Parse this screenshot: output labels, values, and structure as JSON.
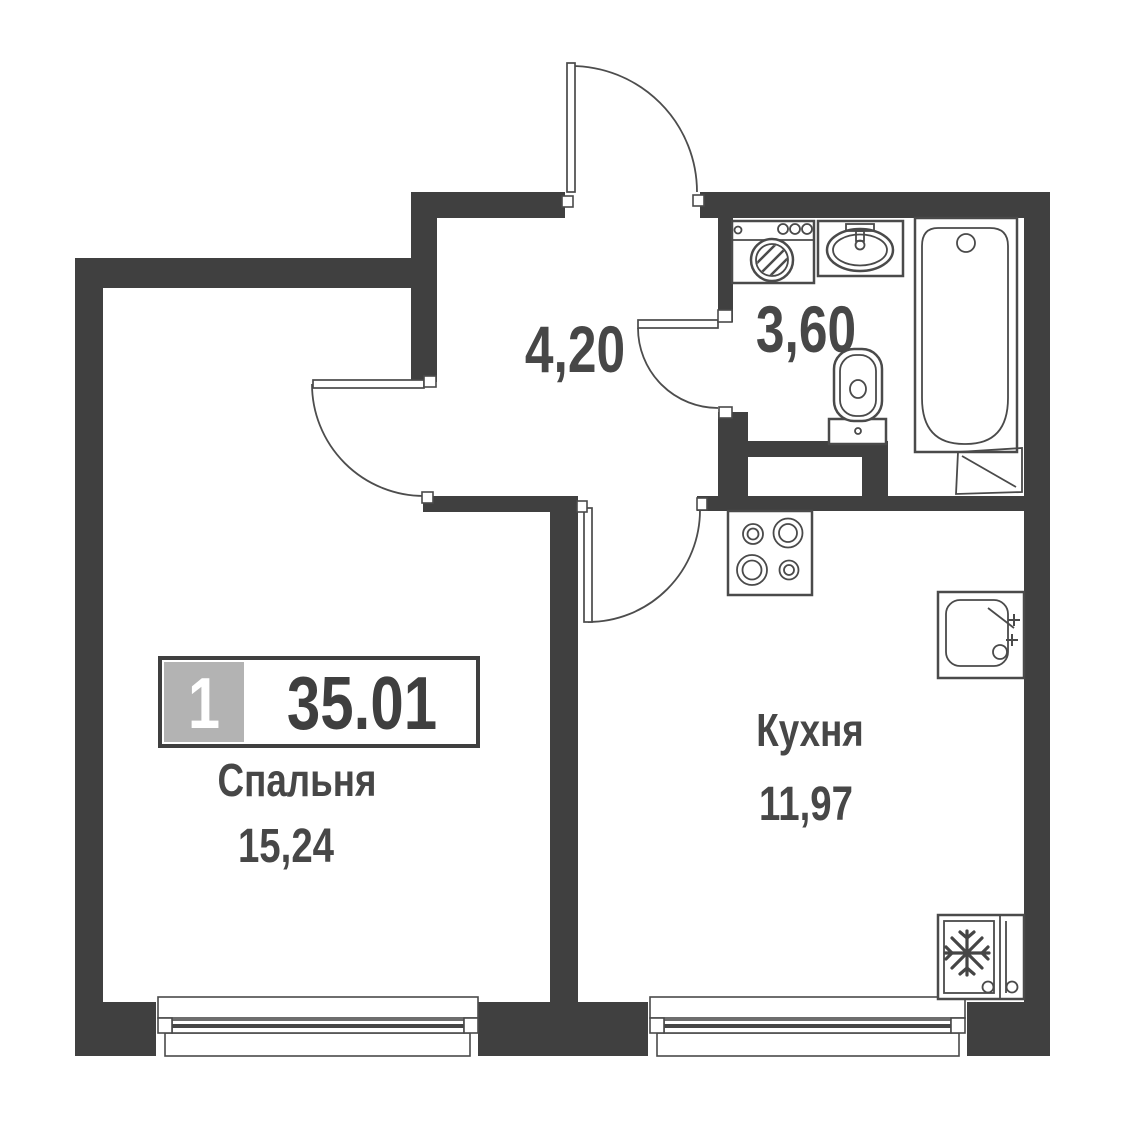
{
  "badge": {
    "number": "1",
    "area_total": "35.01"
  },
  "rooms": {
    "bedroom": {
      "name": "Спальня",
      "area": "15,24"
    },
    "kitchen": {
      "name": "Кухня",
      "area": "11,97"
    },
    "hallway": {
      "area": "4,20"
    },
    "bathroom": {
      "area": "3,60"
    }
  },
  "fixtures": [
    "washing-machine",
    "bathroom-sink",
    "bathtub",
    "toilet",
    "stove",
    "kitchen-sink",
    "refrigerator",
    "vent-shaft"
  ],
  "colors": {
    "wall": "#404040",
    "line": "#4a4a4a",
    "text": "#474747",
    "badge_gray": "#b3b3b3",
    "badge_number": "#ffffff",
    "badge_border": "#3f3f3f",
    "background": "#ffffff"
  }
}
